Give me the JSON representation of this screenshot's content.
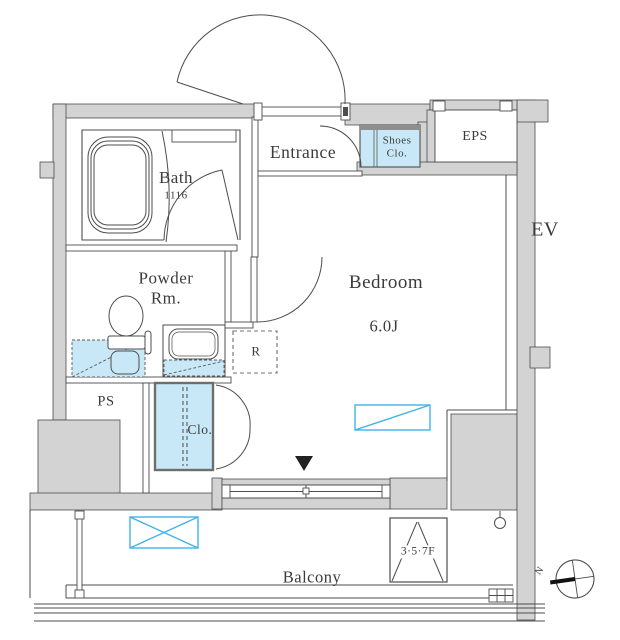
{
  "rooms": {
    "bath": {
      "name": "Bath",
      "size": "1116"
    },
    "powder_room": {
      "line1": "Powder",
      "line2": "Rm."
    },
    "entrance": {
      "name": "Entrance"
    },
    "shoes_closet": {
      "line1": "Shoes",
      "line2": "Clo."
    },
    "eps": {
      "name": "EPS"
    },
    "elevator": {
      "name": "EV"
    },
    "bedroom": {
      "name": "Bedroom",
      "size": "6.0J"
    },
    "balcony": {
      "name": "Balcony"
    }
  },
  "annotations": {
    "refrigerator": "R",
    "pipe_space": "PS",
    "closet": "Clo.",
    "balcony_hatch_floors": "3·5·7F",
    "compass_north": "N"
  },
  "colors": {
    "wall_fill": "#d3d3d3",
    "line": "#4d4d4d",
    "fixture_fill": "#c9e8f7",
    "accent_cyan": "#3fb3e8"
  }
}
